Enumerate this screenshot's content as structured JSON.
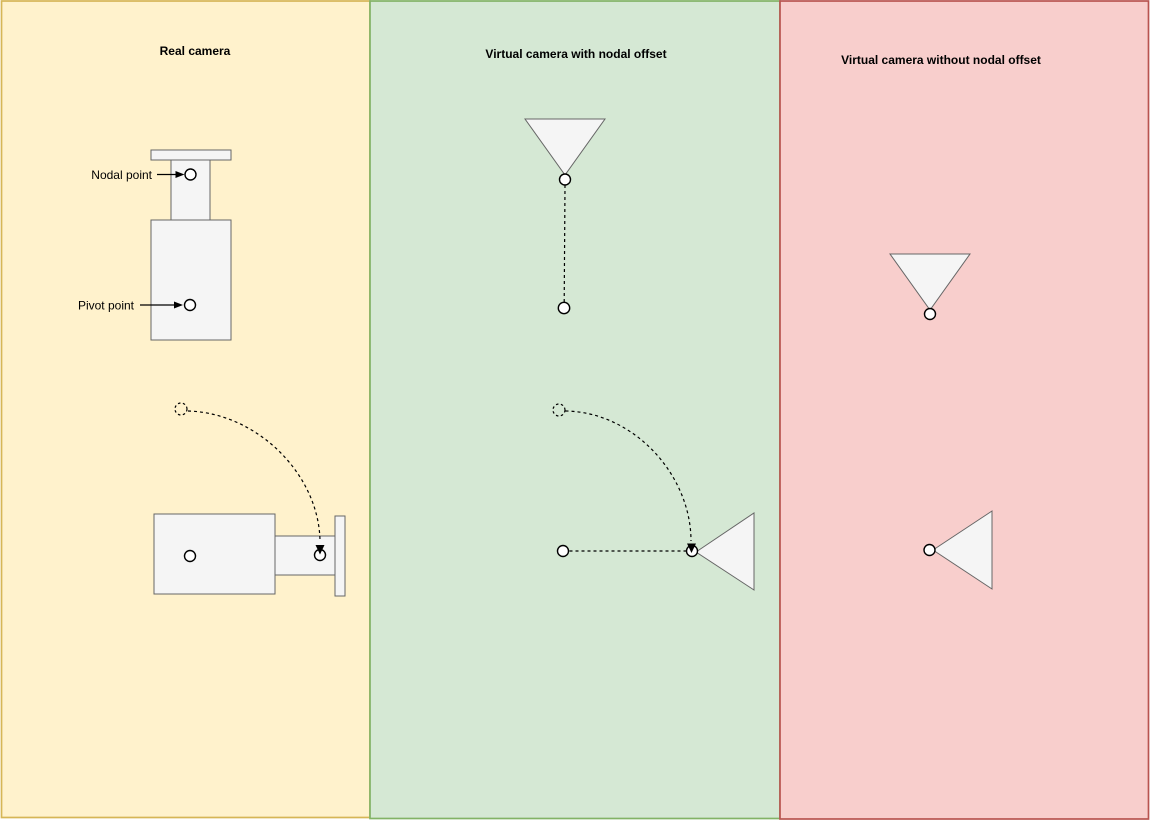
{
  "diagram": {
    "type": "camera-nodal-offset-illustration",
    "panels": [
      {
        "id": "real-camera",
        "title": "Real camera",
        "fill": "#FFF2CC",
        "border": "#D6B656"
      },
      {
        "id": "virtual-camera-with-nodal-offset",
        "title": "Virtual camera with nodal offset",
        "fill": "#D5E8D4",
        "border": "#82B366"
      },
      {
        "id": "virtual-camera-without-nodal-offset",
        "title": "Virtual camera without nodal offset",
        "fill": "#F8CECC",
        "border": "#B85450"
      }
    ],
    "annotations": {
      "nodal_point": "Nodal point",
      "pivot_point": "Pivot point"
    },
    "colors": {
      "shape_fill": "#F5F5F5",
      "shape_stroke": "#666666",
      "marker_fill": "#FFFFFF",
      "marker_stroke": "#000000",
      "connector": "#000000",
      "text": "#000000",
      "canvas_background": "#FFFFFF"
    }
  }
}
